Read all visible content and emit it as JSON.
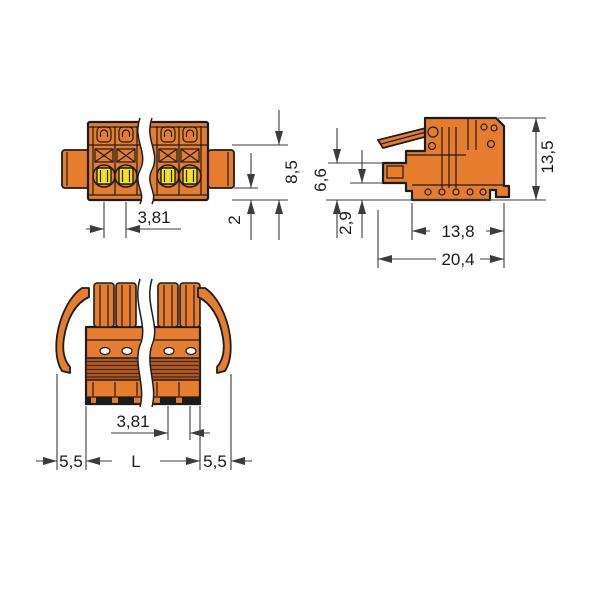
{
  "drawing": {
    "type": "technical-dimension-drawing",
    "views": {
      "front": {
        "dims": {
          "pitch": "3,81",
          "height": "8,5",
          "flange_to_bottom": "2"
        }
      },
      "side": {
        "dims": {
          "overall_height": "13,5",
          "plug_height": "6,6",
          "bottom_clearance": "2,9",
          "housing_depth": "13,8",
          "overall_depth": "20,4"
        }
      },
      "bottom": {
        "dims": {
          "pitch": "3,81",
          "lever_overhang_left": "5,5",
          "housing_length": "L",
          "lever_overhang_right": "5,5"
        }
      }
    },
    "colors": {
      "background": "#FFFFFF",
      "body": "#E67C2E",
      "band": "#B05A20",
      "band_line": "#50260C",
      "button": "#F2E41C",
      "hole": "#FFFFFF",
      "outline": "#1C1C1C",
      "dimension": "#3C3C3C",
      "text": "#1A1A1A"
    }
  }
}
